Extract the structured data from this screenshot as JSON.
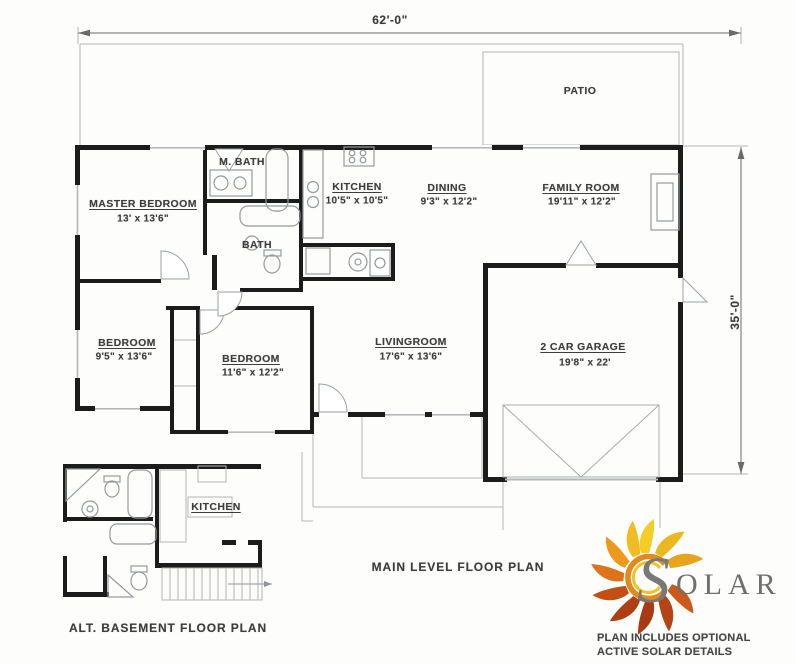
{
  "sheet": {
    "colors": {
      "wall_ink": "#1c1c1c",
      "thin_line": "#b4b7b9",
      "text_ink": "#3d3d3d",
      "logo_yellow": "#f1cd25",
      "logo_orange": "#dd741c",
      "logo_red": "#a83b13",
      "logo_gray": "#787878"
    }
  },
  "dimensions": {
    "width": "62'-0\"",
    "height": "35'-0\""
  },
  "titles": {
    "main": "MAIN LEVEL FLOOR PLAN",
    "basement": "ALT. BASEMENT FLOOR PLAN"
  },
  "rooms": {
    "patio": {
      "name": "PATIO"
    },
    "master_bedroom": {
      "name": "MASTER BEDROOM",
      "size": "13' x 13'6\""
    },
    "m_bath": {
      "name": "M. BATH"
    },
    "bath": {
      "name": "BATH"
    },
    "kitchen": {
      "name": "KITCHEN",
      "size": "10'5\" x 10'5\""
    },
    "dining": {
      "name": "DINING",
      "size": "9'3\" x 12'2\""
    },
    "family_room": {
      "name": "FAMILY ROOM",
      "size": "19'11\" x 12'2\""
    },
    "bedroom_small": {
      "name": "BEDROOM",
      "size": "9'5\" x 13'6\""
    },
    "bedroom_mid": {
      "name": "BEDROOM",
      "size": "11'6\" x 12'2\""
    },
    "livingroom": {
      "name": "LIVINGROOM",
      "size": "17'6\" x 13'6\""
    },
    "garage": {
      "name": "2 CAR GARAGE",
      "size": "19'8\" x 22'"
    },
    "basement_kitchen": {
      "name": "KITCHEN"
    }
  },
  "logo": {
    "s": "S",
    "olar": "OLAR",
    "note1": "PLAN INCLUDES OPTIONAL",
    "note2": "ACTIVE SOLAR DETAILS"
  }
}
